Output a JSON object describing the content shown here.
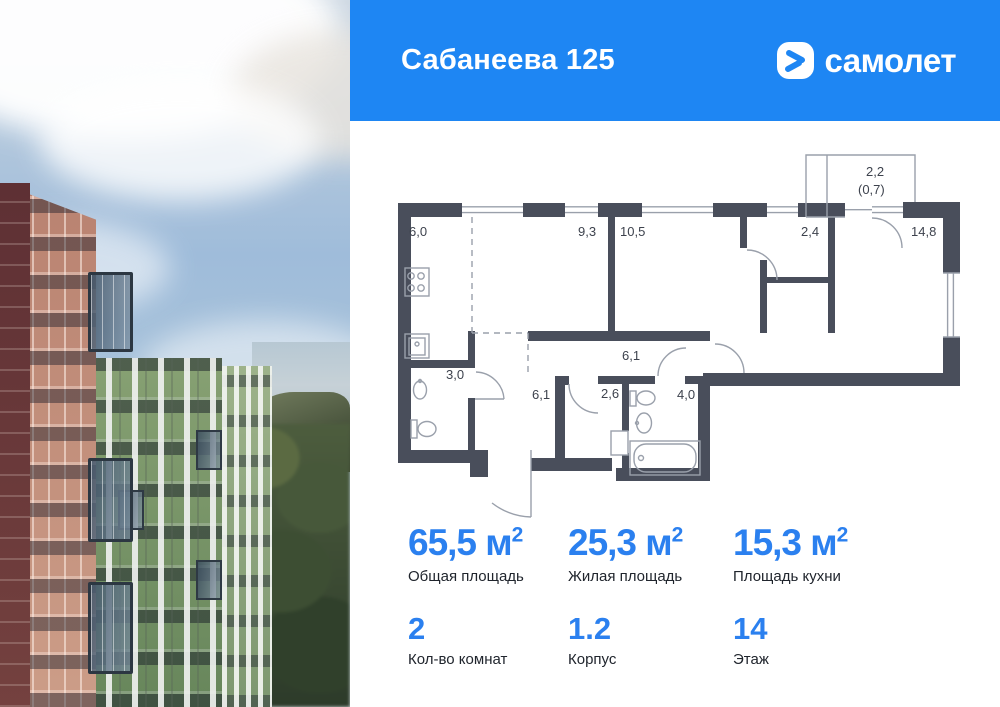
{
  "header": {
    "title": "Сабанеева 125",
    "brand": {
      "name": "самолет",
      "icon": "samolet-chevron-icon"
    },
    "bg_color": "#1e86f3"
  },
  "photo": {
    "description": "residential towers (red-brown and green facades) under cloudy sky, sea horizon and forest"
  },
  "floor_plan": {
    "wall_color": "#494e5b",
    "line_color": "#9aa0ab",
    "room_labels": [
      {
        "text": "6,0",
        "x": 409,
        "y": 236
      },
      {
        "text": "9,3",
        "x": 578,
        "y": 236
      },
      {
        "text": "10,5",
        "x": 620,
        "y": 236
      },
      {
        "text": "2,4",
        "x": 801,
        "y": 236
      },
      {
        "text": "14,8",
        "x": 911,
        "y": 236
      },
      {
        "text": "2,2",
        "x": 866,
        "y": 176
      },
      {
        "text": "(0,7)",
        "x": 858,
        "y": 194
      },
      {
        "text": "3,0",
        "x": 446,
        "y": 379
      },
      {
        "text": "6,1",
        "x": 622,
        "y": 360
      },
      {
        "text": "6,1",
        "x": 532,
        "y": 399
      },
      {
        "text": "2,6",
        "x": 601,
        "y": 398
      },
      {
        "text": "4,0",
        "x": 677,
        "y": 399
      }
    ]
  },
  "stats": {
    "accent_color": "#2b80ef",
    "primary": [
      {
        "value": "65,5",
        "unit": "м",
        "sup": "2",
        "label": "Общая площадь"
      },
      {
        "value": "25,3",
        "unit": "м",
        "sup": "2",
        "label": "Жилая площадь"
      },
      {
        "value": "15,3",
        "unit": "м",
        "sup": "2",
        "label": "Площадь кухни"
      }
    ],
    "secondary": [
      {
        "value": "2",
        "label": "Кол-во комнат"
      },
      {
        "value": "1.2",
        "label": "Корпус"
      },
      {
        "value": "14",
        "label": "Этаж"
      }
    ]
  }
}
